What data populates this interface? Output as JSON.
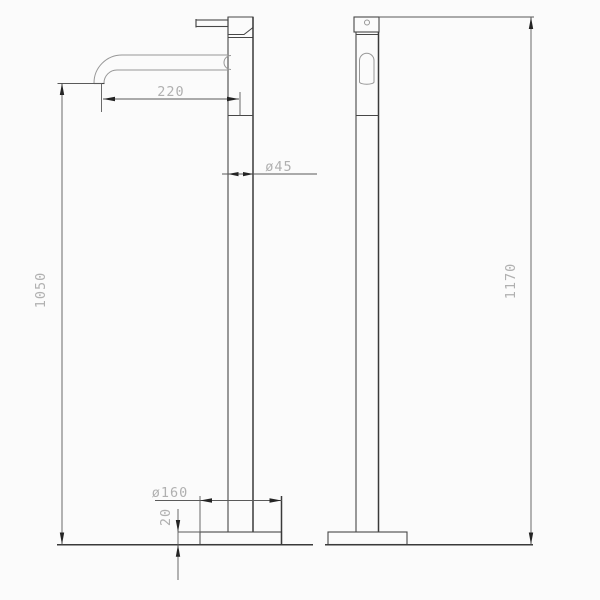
{
  "drawing": {
    "type": "technical-dimension-drawing",
    "subject": "freestanding-floor-mounted-faucet",
    "dimensions": {
      "spout_reach": "220",
      "column_diameter": "ø45",
      "spout_height": "1050",
      "total_height": "1170",
      "base_diameter": "ø160",
      "base_thickness": "20"
    },
    "colors": {
      "background": "#fbfbfb",
      "outline": "#474747",
      "light_line": "#979797",
      "dimension_line": "#5a5a5a",
      "arrowhead": "#242424",
      "dimension_text": "#b0b0b0"
    }
  }
}
